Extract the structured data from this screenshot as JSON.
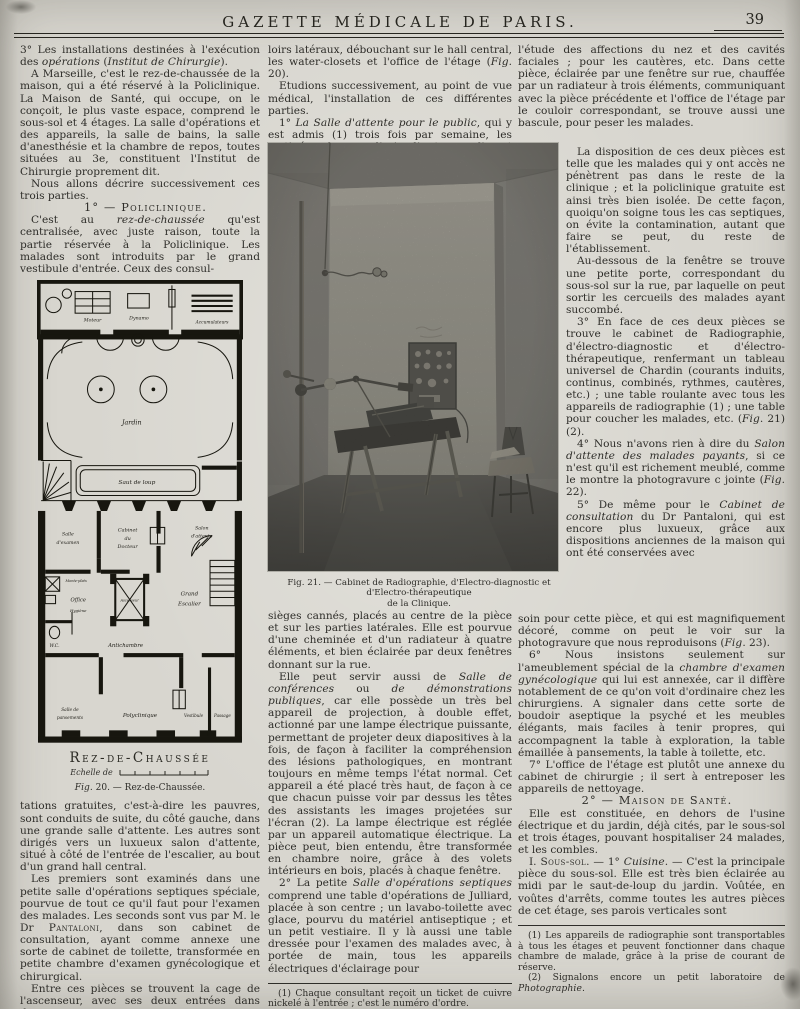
{
  "header": {
    "title": "GAZETTE MÉDICALE DE PARIS.",
    "page_number": "39"
  },
  "left_column": {
    "p1": "3° Les installations destinées à l'exécution des *opérations* (*Institut de Chirurgie*).",
    "p2": "A Marseille, c'est le rez-de-chaussée de la maison, qui a été réservé à la Policlinique. La Maison de Santé, qui occupe, on le conçoit, le plus vaste espace, comprend le sous-sol et 4 étages. La salle d'opérations et des appareils, la salle de bains, la salle d'anesthésie et la chambre de repos, toutes situées au 3e, constituent l'Institut de Chirurgie proprement dit.",
    "p3": "Nous allons décrire successivement ces trois parties.",
    "heading": "1° — Policlinique.",
    "p4": "C'est au *rez-de-chaussée* qu'est centralisée, avec juste raison, toute la partie réservée à la Policlinique. Les malades sont introduits par le grand vestibule d'entrée. Ceux des consul-",
    "p5": "tations gratuites, c'est-à-dire les pauvres, sont conduits de suite, du côté gauche, dans une grande salle d'attente. Les autres sont dirigés vers un luxueux salon d'attente, situé à côté de l'entrée de l'escalier, au bout d'un grand hall central.",
    "p6": "Les premiers sont examinés dans une petite salle d'opérations septiques spéciale, pourvue de tout ce qu'il faut pour l'examen des malades. Les seconds sont vus par M. le Dr ^Pantaloni^, dans son cabinet de consultation, ayant comme annexe une sorte de cabinet de toilette, transformée en petite chambre d'examen gynécologique et chirurgical.",
    "p7": "Entre ces pièces se trouvent la cage de l'ascenseur, avec ses deux entrées dans deux cou-"
  },
  "figure20": {
    "title": "Rez-de-Chaussée",
    "scale_label": "Echelle de",
    "caption": "*Fig*. 20. — Rez-de-Chaussée.",
    "labels": {
      "moteur": "Moteur",
      "dynamo": "Dynamo",
      "accumulateurs": "Accumulateurs",
      "jardin": "Jardin",
      "saut_de_loup": "Saut de loup",
      "salle_examen_1": "Salle",
      "salle_examen_2": "d'examen",
      "cabinet_1": "Cabinet",
      "cabinet_2": "du",
      "cabinet_3": "Docteur",
      "salon_1": "Salon",
      "salon_2": "d'attente",
      "monte_plats": "Monte-plats",
      "office": "Office",
      "hygiene": "Hygiène",
      "ascenseur": "Ascenseur",
      "grand_escalier_1": "Grand",
      "grand_escalier_2": "Escalier",
      "wc": "W.C.",
      "antichambre": "Antichambre",
      "pansements_1": "Salle de",
      "pansements_2": "pansements",
      "polyclinique": "Polyclinique",
      "vestibule": "Vestibule",
      "passage": "Passage"
    }
  },
  "figure21": {
    "caption_line1": "Fig. 21. — Cabinet de Radiographie, d'Electro-diagnostic et d'Electro-thérapeutique",
    "caption_line2": "de la Clinique."
  },
  "middle_column": {
    "p1": "loirs latéraux, débouchant sur le hall central, les water-closets et l'office de l'étage (*Fig*. 20).",
    "p2": "Etudions successivement, au point de vue médical, l'installation de ces différentes parties.",
    "p3": "1° *La Salle d'attente pour le public*, qui y est admis (1) trois fois par semaine, les matinées des mardi, jeudi et samedi, est meublée de grands",
    "p4": "sièges cannés, placés au centre de la pièce et sur les parties latérales. Elle est pourvue d'une cheminée et d'un radiateur à quatre éléments, et bien éclairée par deux fenêtres donnant sur la rue.",
    "p5": "Elle peut servir aussi de *Salle de conférences* ou *de démonstrations publiques*, car elle possède un très bel appareil de projection, à double effet, actionné par une lampe électrique puissante, permettant de projeter deux diapositives à la fois, de façon à faciliter la compréhension des lésions pathologiques, en montrant toujours en même temps l'état normal. Cet appareil a été placé très haut, de façon à ce que chacun puisse voir par dessus les têtes des assistants les images projetées sur l'écran (2). La lampe électrique est réglée par un appareil automatique électrique. La pièce peut, bien entendu, être transformée en chambre noire, grâce à des volets intérieurs en bois, placés à chaque fenêtre.",
    "p6": "2° La petite *Salle d'opérations septiques* comprend une table d'opérations de Julliard, placée à son centre ; un lavabo-toilette avec glace, pourvu du matériel antiseptique ; et un petit vestiaire. Il y là aussi une table dressée pour l'examen des malades avec, à portée de main, tous les appareils électriques d'éclairage pour",
    "footnote1": "(1) Chaque consultant reçoit un ticket de cuivre nickelé à l'entrée ; c'est le numéro d'ordre.",
    "footnote2": "(2) Disposition imitée de celle du cercle Volney à Paris."
  },
  "right_column": {
    "p1": "l'étude des affections du nez et des cavités faciales ; pour les cautères, etc. Dans cette pièce, éclairée par une fenêtre sur rue, chauffée par un radiateur à trois éléments, communiquant avec la pièce précédente et l'office de l'étage par le couloir correspondant, se trouve aussi une bascule, pour peser les malades.",
    "p2": "La disposition de ces deux pièces est telle que les malades qui y ont accès ne pénètrent pas dans le reste de la clinique ; et la policlinique gratuite est ainsi très bien isolée. De cette façon, quoiqu'on soigne tous les cas septiques, on évite la contamination, autant que faire se peut, du reste de l'établissement.",
    "p3": "Au-dessous de la fenêtre se trouve une petite porte, correspondant du sous-sol sur la rue, par laquelle on peut sortir les cercueils des malades ayant succombé.",
    "p4": "3° En face de ces deux pièces se trouve le cabinet de Radiographie, d'électro-diagnostic et d'électro-thérapeutique, renfermant un tableau universel de Chardin (courants induits, continus, combinés, rythmes, cautères, etc.) ; une table roulante avec tous les appareils de radiographie (1) ; une table pour coucher les malades, etc. (*Fig*. 21) (2).",
    "p5": "4° Nous n'avons rien à dire du *Salon d'attente des malades payants*, si ce n'est qu'il est richement meublé, comme le montre la photogravure c jointe (*Fig*. 22).",
    "p6": "5° De même pour le *Cabinet de consultation* du Dr Pantaloni, qui est encore plus luxueux, grâce aux dispositions anciennes de la maison qui ont été conservées avec",
    "p7": "soin pour cette pièce, et qui est magnifiquement décoré, comme on peut le voir sur la photogravure que nous reproduisons (*Fig*. 23).",
    "p8": "6° Nous insistons seulement sur l'ameublement spécial de la *chambre d'examen gynécologique* qui lui est annexée, car il diffère notablement de ce qu'on voit d'ordinaire chez les chirurgiens. A signaler dans cette sorte de boudoir aseptique la psyché et les meubles élégants, mais faciles à tenir propres, qui accompagnent la table à exploration, la table émaillée à pansements, la table à toilette, etc.",
    "p9": "7° L'office de l'étage est plutôt une annexe du cabinet de chirurgie ; il sert à entreposer les appareils de nettoyage.",
    "heading": "2° — Maison de Santé.",
    "p10": "Elle est constituée, en dehors de l'usine électrique et du jardin, déjà cités, par le sous-sol et trois étages, pouvant hospitaliser 24 malades, et les combles.",
    "p11": "I. ^Sous-sol^. — 1° *Cuisine*. — C'est la principale pièce du sous-sol. Elle est très bien éclairée au midi par le saut-de-loup du jardin. Voûtée, en voûtes d'arrêts, comme toutes les autres pièces de cet étage, ses parois verticales sont",
    "footnote1": "(1) Les appareils de radiographie sont transportables à tous les étages et peuvent fonctionner dans chaque chambre de malade, grâce à la prise de courant de réserve.",
    "footnote2": "(2) Signalons encore un petit laboratoire de *Photographie*."
  }
}
